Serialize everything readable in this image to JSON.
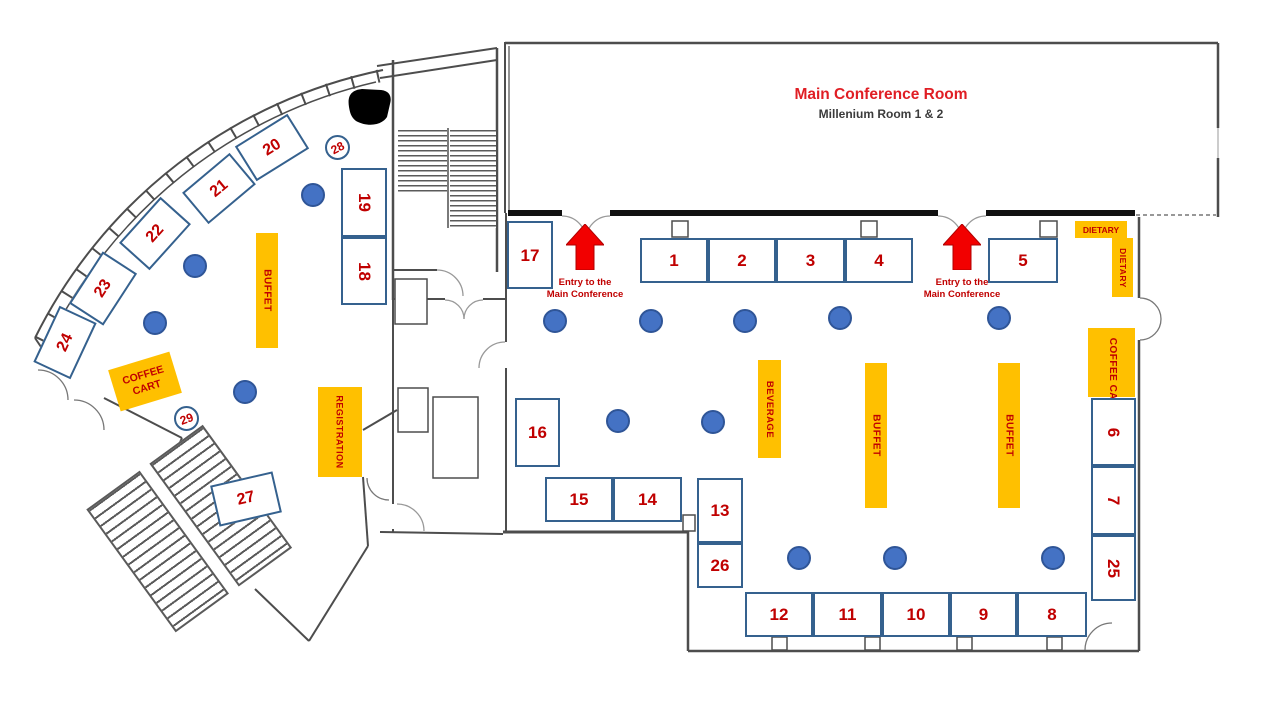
{
  "header": {
    "title": "Main Conference Room",
    "subtitle": "Millenium Room 1 & 2"
  },
  "entry": {
    "line1": "Entry to the",
    "line2": "Main Conference"
  },
  "labels": {
    "buffet": "BUFFET",
    "beverage": "BEVERAGE",
    "coffee_cart": "COFFEE CART",
    "registration": "REGISTRATION",
    "dietary": "DIETARY"
  },
  "booths": {
    "b1": "1",
    "b2": "2",
    "b3": "3",
    "b4": "4",
    "b5": "5",
    "b6": "6",
    "b7": "7",
    "b8": "8",
    "b9": "9",
    "b10": "10",
    "b11": "11",
    "b12": "12",
    "b13": "13",
    "b14": "14",
    "b15": "15",
    "b16": "16",
    "b17": "17",
    "b18": "18",
    "b19": "19",
    "b20": "20",
    "b21": "21",
    "b22": "22",
    "b23": "23",
    "b24": "24",
    "b25": "25",
    "b26": "26",
    "b27": "27",
    "b28": "28",
    "b29": "29"
  },
  "colors": {
    "booth_border": "#35618E",
    "number_red": "#C00000",
    "label_yellow": "#FFC000",
    "arrow_red": "#F20000",
    "table_blue": "#4472C4",
    "wall_gray": "#4D4D4D",
    "title_red": "#E01E24"
  }
}
